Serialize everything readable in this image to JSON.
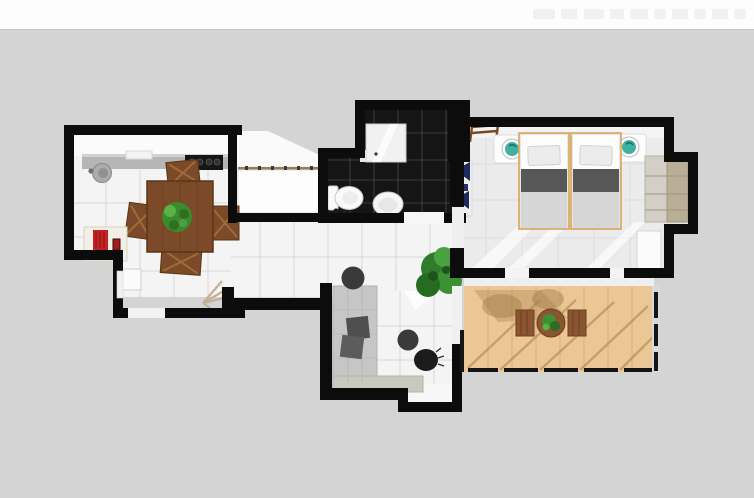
{
  "page": {
    "kind": "3d-top-down-apartment-floor-plan-render",
    "background_color": "#d4d4d4",
    "top_band_color": "#fdfdfd",
    "watermark": ""
  },
  "palette": {
    "wall": "#0c0c0c",
    "floor_tile": "#f4f4f4",
    "grout": "#d7d7d7",
    "bedroom_floor": "#ebebeb",
    "bathroom_tile": "#151515",
    "bathroom_grout": "#4a4a4a",
    "deck_wood": "#e9c globe",
    "deck": "#eac795",
    "deck_shadow": "#a97f48",
    "furniture_wood": "#7b4a28",
    "sofa_gray": "#c6c6c6",
    "cushion_gray": "#4f4f4f",
    "counter_gray": "#b6b6b6",
    "cooktop_black": "#161616",
    "teal_bowl": "#3fb0a2",
    "navy_accent": "#1f2a5a",
    "red_accent": "#c32222",
    "plant_green": "#3c8a2e",
    "bed_blanket_dark": "#575757",
    "bed_blanket_light": "#d6d6d6",
    "bed_frame_tan": "#d8a558",
    "wardrobe_tan": "#bbae97"
  },
  "rooms": {
    "kitchen": {
      "label": "kitchen-dining-room",
      "furniture": [
        "kitchen-counter",
        "kitchen-sink",
        "cooktop",
        "dining-table",
        "dining-chairs",
        "table-plant",
        "cabinet-with-red-appliance",
        "entry-door-mat",
        "dried-palm-decor"
      ]
    },
    "closet": {
      "label": "hall-closet-bed-nook",
      "furniture": [
        "white-bed-closet"
      ]
    },
    "bathroom": {
      "label": "bathroom",
      "furniture": [
        "shower",
        "toilet",
        "pedestal-sink",
        "bath-mat"
      ]
    },
    "bedroom": {
      "label": "bedroom",
      "furniture": [
        "twin-bed-left",
        "twin-bed-right",
        "nightstand-left",
        "nightstand-right",
        "teal-bowl-left",
        "teal-bowl-right",
        "wardrobe",
        "white-cabinet",
        "luggage-rack",
        "navy-wall-decor"
      ]
    },
    "living": {
      "label": "living-area",
      "furniture": [
        "sectional-sofa",
        "dark-pouf-hall",
        "dark-pouf-living",
        "black-vase",
        "floor-plant"
      ]
    },
    "terrace": {
      "label": "wood-deck-terrace",
      "furniture": [
        "bistro-table",
        "terrace-plant",
        "deck-chair-left",
        "deck-chair-right",
        "railing"
      ]
    }
  }
}
